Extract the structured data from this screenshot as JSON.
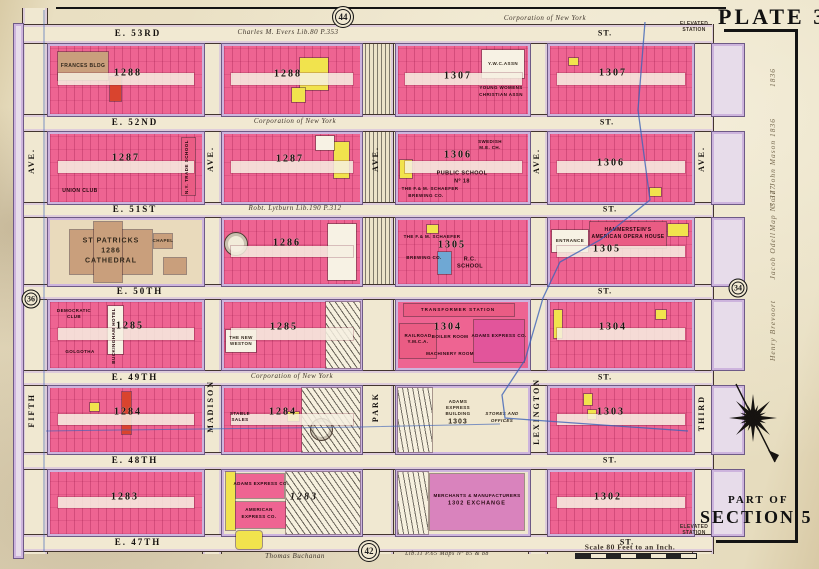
{
  "plate": {
    "title": "PLATE 35",
    "part_of": "PART OF",
    "section": "SECTION 5",
    "corporation_top": "Corporation  of   New York",
    "scale_label": "Scale 80 Feet to an Inch.",
    "thomas_note": "Thomas Buchanan",
    "lib_note": "Lib.11 P.65  Maps Nº 85 & 88",
    "elevated_top": "ELEVATED STATION",
    "elevated_bottom": "ELEVATED STATION"
  },
  "badges": {
    "top": "44",
    "left": "36",
    "right": "34",
    "bottom": "42"
  },
  "streets": [
    {
      "name": "E. 53RD",
      "note": "Charles M. Evers  Lib.80 P.353",
      "st": "ST."
    },
    {
      "name": "E. 52ND",
      "note": "Corporation  of  New York",
      "st": "ST."
    },
    {
      "name": "E. 51ST",
      "note": "Robt. Lytburn  Lib.190 P.312",
      "st": "ST."
    },
    {
      "name": "E. 50TH",
      "note": "",
      "st": "ST."
    },
    {
      "name": "E. 49TH",
      "note": "Corporation  of  New York",
      "st": "ST."
    },
    {
      "name": "E. 48TH",
      "note": "",
      "st": "ST."
    },
    {
      "name": "E. 47TH",
      "note": "",
      "st": "ST."
    }
  ],
  "avenues": {
    "fifth": {
      "name": "FIFTH",
      "ave": "AVE."
    },
    "madison": {
      "name": "MADISON",
      "ave": "AVE."
    },
    "park": {
      "name": "PARK",
      "ave": "AVE."
    },
    "lexington": {
      "name": "LEXINGTON",
      "ave": "AVE."
    },
    "third": {
      "name": "THIRD",
      "ave": "AVE."
    }
  },
  "blocks": {
    "a1": {
      "number": "1288",
      "frances": "FRANCES BLDG"
    },
    "b1": {
      "number": "1288"
    },
    "c1": {
      "number": "1307",
      "ywca_bldg": "Y.W.C.ASSN",
      "ywca1": "YOUNG WOMENS",
      "ywca2": "CHRISTIAN ASSN"
    },
    "d1": {
      "number": "1307"
    },
    "a2": {
      "number": "1287",
      "union": "UNION CLUB",
      "trade": "N.Y. TRADE SCHOOL"
    },
    "b2": {
      "number": "1287"
    },
    "c2": {
      "number": "1306",
      "swedish1": "SWEDISH",
      "swedish2": "M.E. CH.",
      "ps1": "PUBLIC SCHOOL",
      "ps2": "Nº 18",
      "schaefer1": "THE F.& M. SCHAEFER",
      "schaefer2": "BREWING CO."
    },
    "d2": {
      "number": "1306"
    },
    "a3": {
      "cathedral1": "ST PATRICKS",
      "cathedral2": "1286",
      "cathedral3": "CATHEDRAL",
      "chapel": "CHAPEL"
    },
    "b3": {
      "number": "1286"
    },
    "c3": {
      "number": "1305",
      "schaefer1": "THE F.& M. SCHAEFER",
      "schaefer2": "BREWING CO.",
      "rc1": "R.C.",
      "rc2": "SCHOOL"
    },
    "d3": {
      "number": "1305",
      "ham1": "HAMMERSTEIN'S",
      "ham2": "AMERICAN OPERA HOUSE",
      "entrance": "ENTRANCE"
    },
    "a4": {
      "number": "1285",
      "club1": "DEMOCRATIC",
      "club2": "CLUB",
      "hotel": "BUCKINGHAM HOTEL",
      "golgotha": "GOLGOTHA"
    },
    "b4": {
      "number": "1285",
      "weston1": "THE NEW",
      "weston2": "WESTON"
    },
    "c4": {
      "number": "1304",
      "transformer": "TRANSFORMER STATION",
      "rr1": "RAILROAD",
      "rr2": "Y.M.C.A.",
      "boiler": "BOILER ROOM",
      "machinery": "MACHINERY ROOM",
      "adams": "ADAMS EXPRESS CO."
    },
    "d4": {
      "number": "1304"
    },
    "a5": {
      "number": "1284"
    },
    "b5": {
      "number": "1284",
      "stable1": "STABLE",
      "stable2": "SALES"
    },
    "c5": {
      "adams1": "ADAMS",
      "adams2": "EXPRESS",
      "adams3": "BUILDING",
      "adams_num": "1303",
      "stores1": "STORES AND",
      "stores2": "OFFICES"
    },
    "d5": {
      "number": "1303"
    },
    "a6": {
      "number": "1283"
    },
    "b6": {
      "number": "1283",
      "adams": "ADAMS EXPRESS CO.",
      "american1": "AMERICAN",
      "american2": "EXPRESS CO."
    },
    "c6": {
      "merch1": "MERCHANTS & MANUFACTURERS",
      "merch2": "1302 EXCHANGE"
    },
    "d6": {
      "number": "1302"
    }
  },
  "handwriting": [
    "1836",
    "Sold John Mason 1836",
    "Map Nº 377",
    "Jacob Odell",
    "Henry Brevoort"
  ],
  "colors": {
    "brick_pink": "#ee6492",
    "frame_yellow": "#f1e34d",
    "stone_tan": "#c99f7c",
    "water_blue": "#3d63b8",
    "sidewalk_lavender": "#cdb4dd",
    "paper": "#ece3c8"
  }
}
